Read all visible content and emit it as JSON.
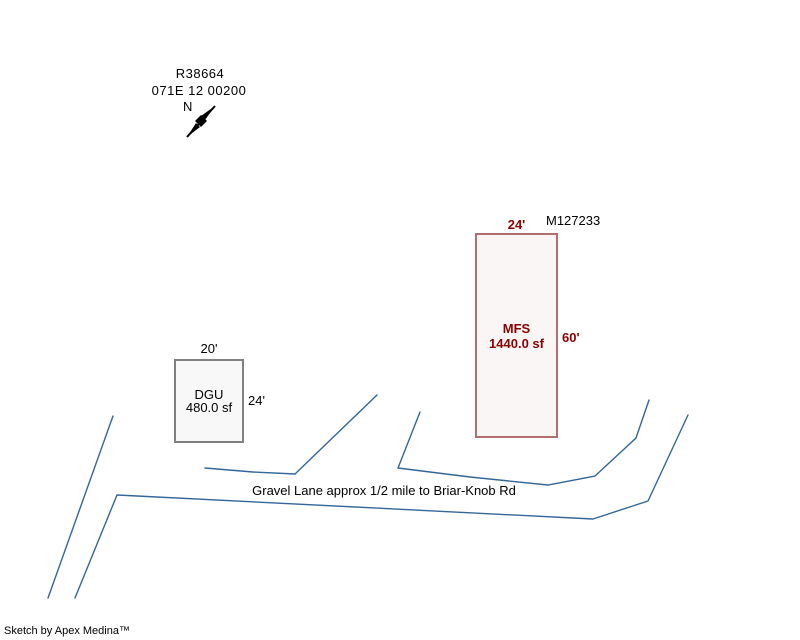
{
  "colors": {
    "background": "#FFFFFF",
    "ink": "#000000",
    "road_line": "#336699",
    "mfs_outline": "#B07070",
    "mfs_fill": "#FBF6F6",
    "mfs_text": "#8B0000",
    "dgu_outline": "#808080",
    "dgu_fill": "#F8F8F8"
  },
  "header": {
    "parcel_id": "R38664",
    "map_number": "071E 12 00200"
  },
  "compass": {
    "north_label": "N"
  },
  "buildings": {
    "mfs": {
      "tag": "M127233",
      "top_dim": "24'",
      "right_dim": "60'",
      "name": "MFS",
      "area": "1440.0 sf"
    },
    "dgu": {
      "top_dim": "20'",
      "right_dim": "24'",
      "name": "DGU",
      "area": "480.0 sf"
    }
  },
  "road": {
    "label": "Gravel Lane approx 1/2 mile to Briar-Knob Rd"
  },
  "footer": {
    "credit": "Sketch by Apex Medina™"
  }
}
